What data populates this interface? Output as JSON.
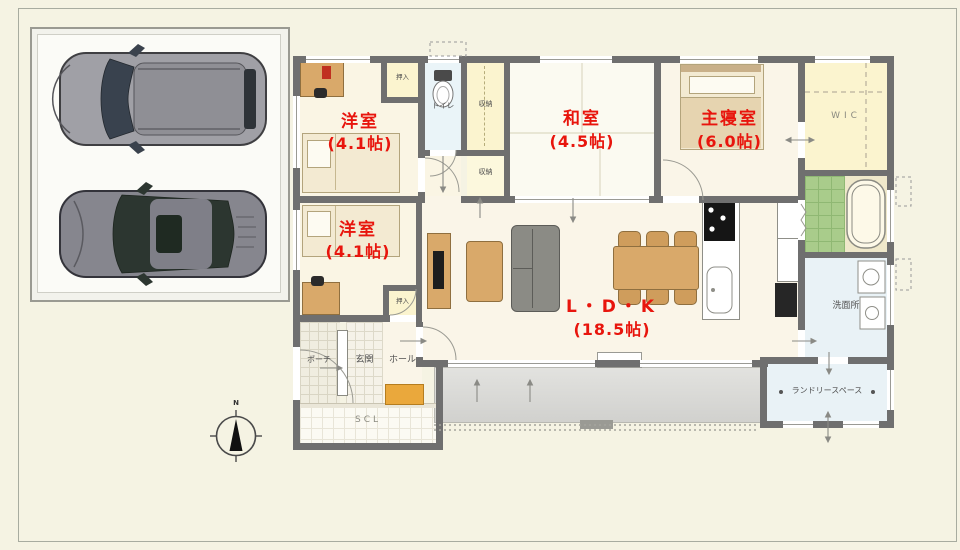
{
  "plan": {
    "rooms": {
      "yoshitsu1": {
        "name": "洋室",
        "size": "(4.1帖)"
      },
      "washitsu": {
        "name": "和室",
        "size": "(4.5帖)"
      },
      "shushinshitsu": {
        "name": "主寝室",
        "size": "(6.0帖)"
      },
      "yoshitsu2": {
        "name": "洋室",
        "size": "(4.1帖)"
      },
      "ldk": {
        "name": "L・D・K",
        "size": "(18.5帖)"
      }
    },
    "small_labels": {
      "wic": "WIC",
      "toilet": "トイレ",
      "storage_upper": "収納",
      "storage_lower": "収納",
      "oshiire_upper": "押入",
      "oshiire_lower": "押入",
      "senmenjo": "洗面所",
      "porch": "ポーチ",
      "genkan": "玄関",
      "hall": "ホール",
      "scl": "SCL",
      "laundry": "ランドリースペース"
    },
    "compass": {
      "north": "N"
    }
  },
  "colors": {
    "room_label": "#e8150d",
    "wall": "#6f6f6f",
    "closet_floor": "#fbf4cf",
    "water_floor": "#e9f2f6",
    "bath_tile": "#a9cc8b",
    "wood_furniture": "#d9a96a",
    "deck": "#dcdcd8",
    "cabinet_accent": "#eaa83c"
  }
}
